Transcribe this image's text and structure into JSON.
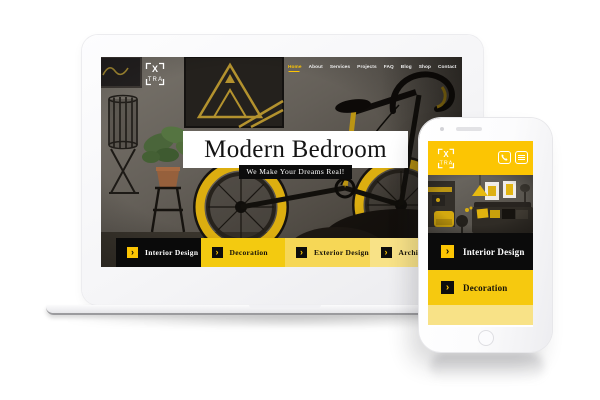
{
  "ui": {
    "arrow": "›"
  },
  "laptop_site": {
    "logo": {
      "top": "X",
      "bottom": "TRA"
    },
    "nav": {
      "items": [
        {
          "label": "Home",
          "active": true
        },
        {
          "label": "About",
          "active": false
        },
        {
          "label": "Services",
          "active": false
        },
        {
          "label": "Projects",
          "active": false
        },
        {
          "label": "FAQ",
          "active": false
        },
        {
          "label": "Blog",
          "active": false
        },
        {
          "label": "Shop",
          "active": false
        },
        {
          "label": "Contact",
          "active": false
        }
      ]
    },
    "hero": {
      "title": "Modern Bedroom",
      "tagline": "We Make Your Dreams Real!"
    },
    "categories": [
      {
        "label": "Interior Design"
      },
      {
        "label": "Decoration"
      },
      {
        "label": "Exterior Design"
      },
      {
        "label": "Architecture"
      }
    ]
  },
  "phone_site": {
    "logo": {
      "top": "X",
      "bottom": "TRA"
    },
    "header_icons": [
      "phone-icon",
      "menu-icon"
    ],
    "categories": [
      {
        "label": "Interior Design"
      },
      {
        "label": "Decoration"
      }
    ]
  },
  "colors": {
    "brand_yellow": "#fcc503",
    "category_yellow_1": "#f3ca10",
    "category_yellow_2": "#f6d756",
    "category_yellow_3": "#f8e287",
    "phone_yellow": "#f6c90f",
    "button_dark": "#0b0b0b"
  }
}
